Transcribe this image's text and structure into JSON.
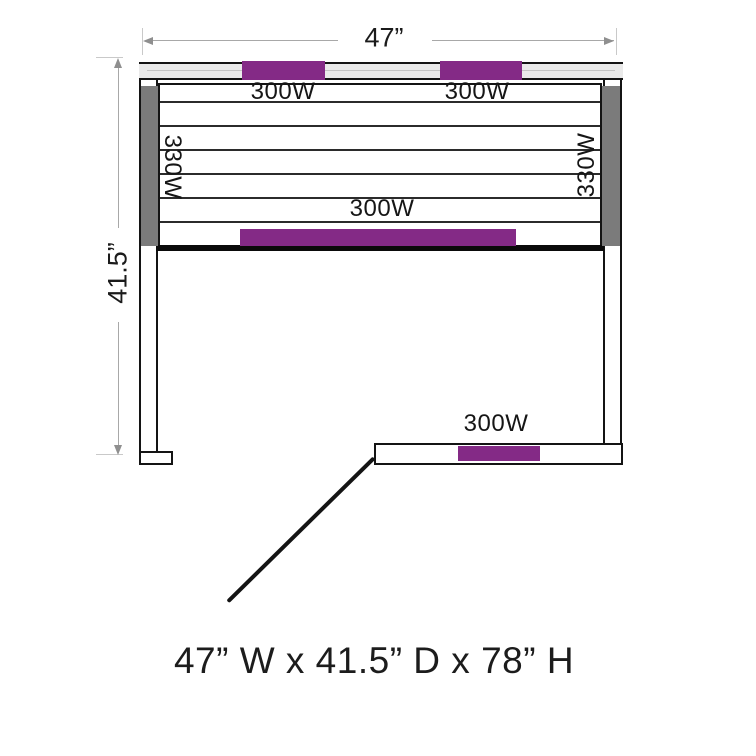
{
  "diagram": {
    "caption": "47” W x 41.5” D x 78” H"
  },
  "dimensions": {
    "width_label": "47”",
    "depth_label": "41.5”"
  },
  "heaters": {
    "top_left": "300W",
    "top_right": "300W",
    "left_side": "330W",
    "right_side": "330W",
    "bench_front": "300W",
    "bottom_wall": "300W"
  },
  "icons": {
    "dimension_arrows": "thin gray arrowheads at both ends of dimension lines",
    "door_swing": "diagonal line indicating open door"
  },
  "colors": {
    "heater_accent": "#842a86",
    "side_heater_gray": "#7b7b7b",
    "wall_line": "#141414",
    "top_wall_fill": "#eaeaea",
    "dimension_line": "#a8a8a8"
  }
}
